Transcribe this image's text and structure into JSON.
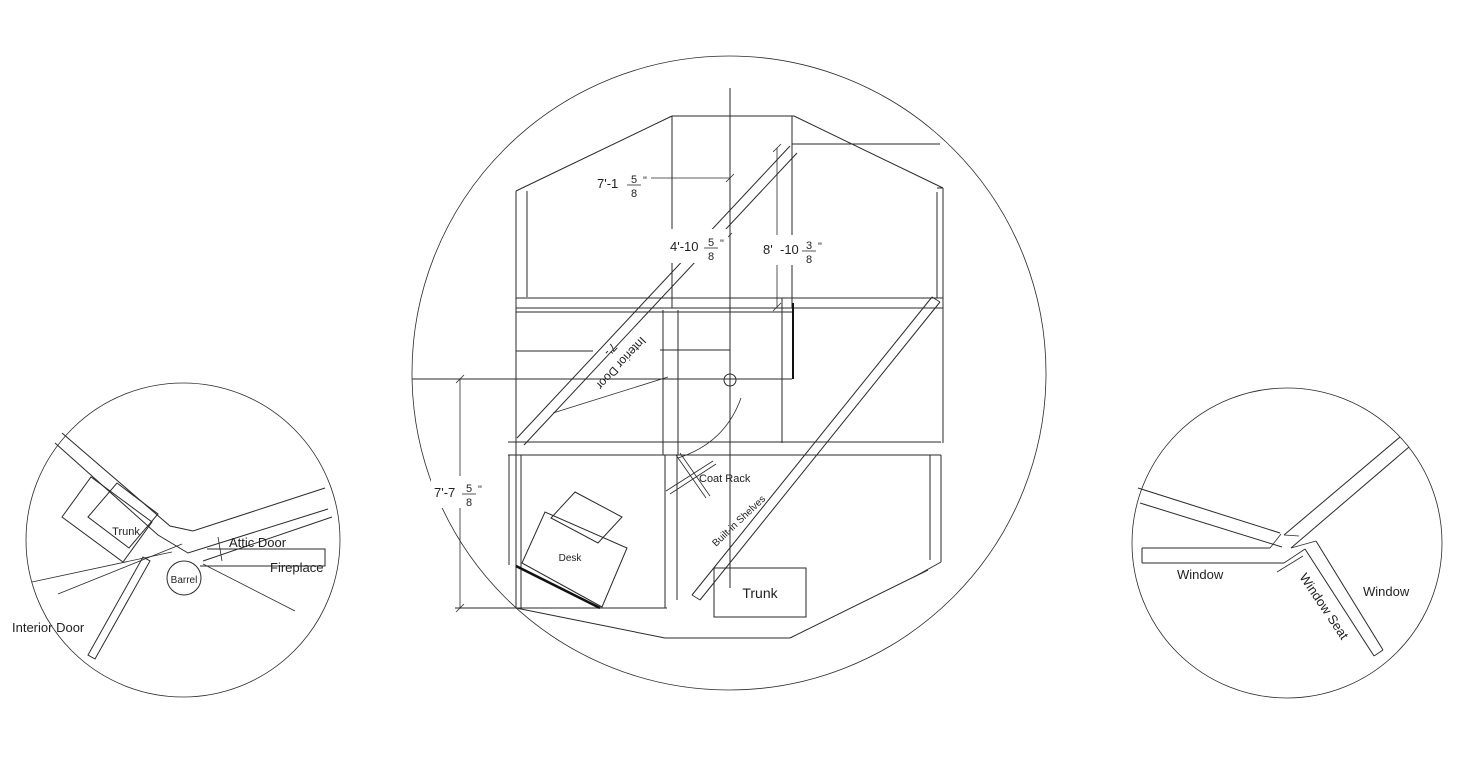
{
  "drawing": {
    "background": "#ffffff",
    "line_color": "#2a2a2a"
  },
  "main_plan": {
    "dims": {
      "top": {
        "main": "7'-1",
        "num": "5",
        "den": "8",
        "qt": "\""
      },
      "middle": {
        "main": "4'-10",
        "num": "5",
        "den": "8",
        "qt": "\""
      },
      "right": {
        "main1": "8'",
        "main2": "-10",
        "num": "3",
        "den": "8",
        "qt": "\""
      },
      "left": {
        "main": "7'-7",
        "num": "5",
        "den": "8",
        "qt": "\""
      }
    },
    "labels": {
      "interior_door": "Interior Door",
      "door_dim_fragment": "7'-",
      "coat_rack": "Coat Rack",
      "built_in_shelves": "Built-in Shelves",
      "desk": "Desk",
      "trunk": "Trunk"
    }
  },
  "left_detail": {
    "labels": {
      "trunk": "Trunk",
      "attic_door": "Attic Door",
      "fireplace": "Fireplace",
      "barrel": "Barrel",
      "interior_door": "Interior Door"
    }
  },
  "right_detail": {
    "labels": {
      "window_left": "Window",
      "window_seat": "Window Seat",
      "window_right": "Window"
    }
  }
}
